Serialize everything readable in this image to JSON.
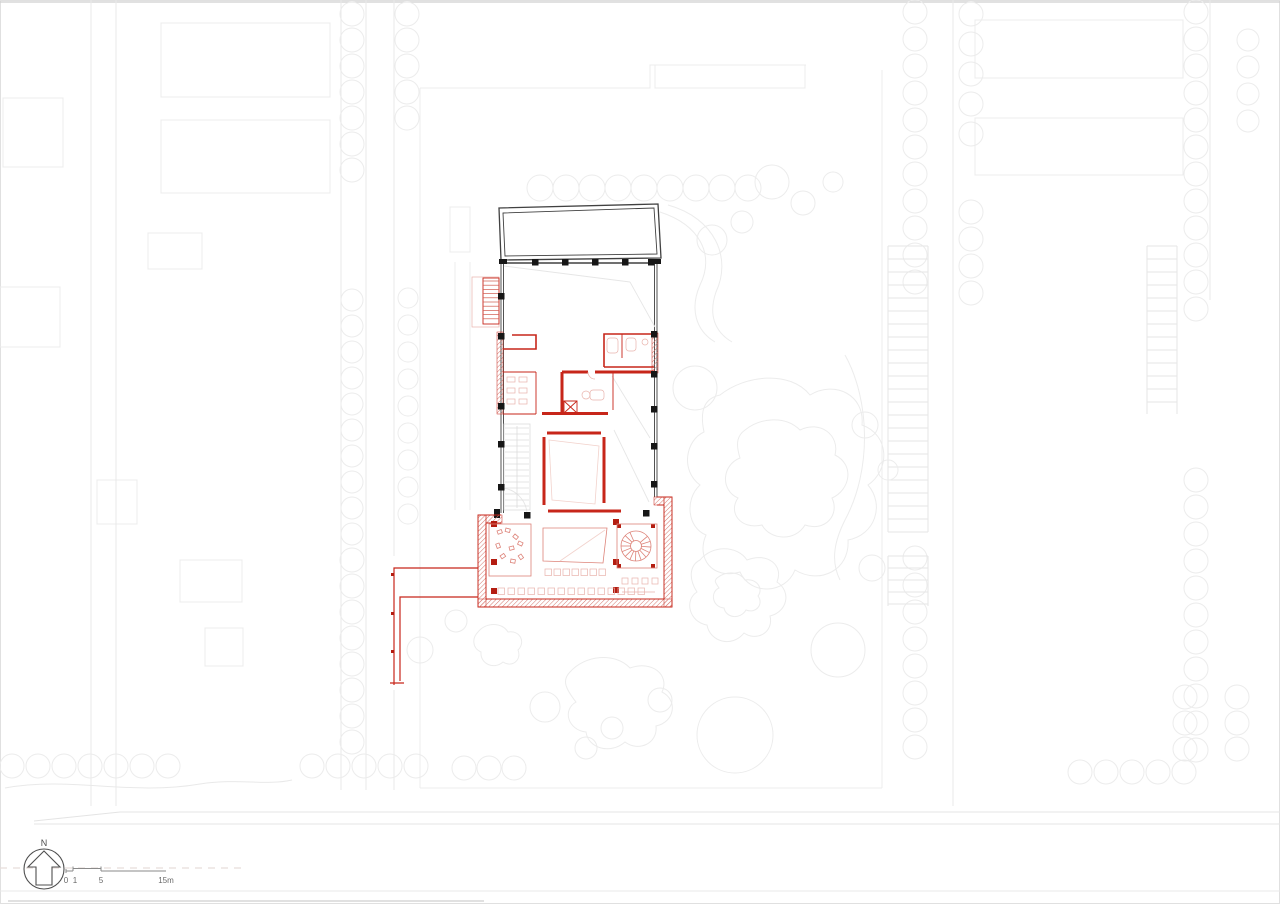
{
  "annotations": {
    "north_label": "N",
    "scale_bar": {
      "t0": "0",
      "t1": "1",
      "t5": "5",
      "t15": "15m"
    }
  },
  "icons": {
    "north_arrow": "north-arrow-icon",
    "scale_bar": "scale-bar"
  },
  "colors": {
    "bg": "#ffffff",
    "red": "#c7261a",
    "redcol": "#b41d11",
    "lred": "#dd8379",
    "hatch": "#d4756b",
    "dark": "#414141",
    "blk": "#161616",
    "ctx": "#ececec"
  }
}
